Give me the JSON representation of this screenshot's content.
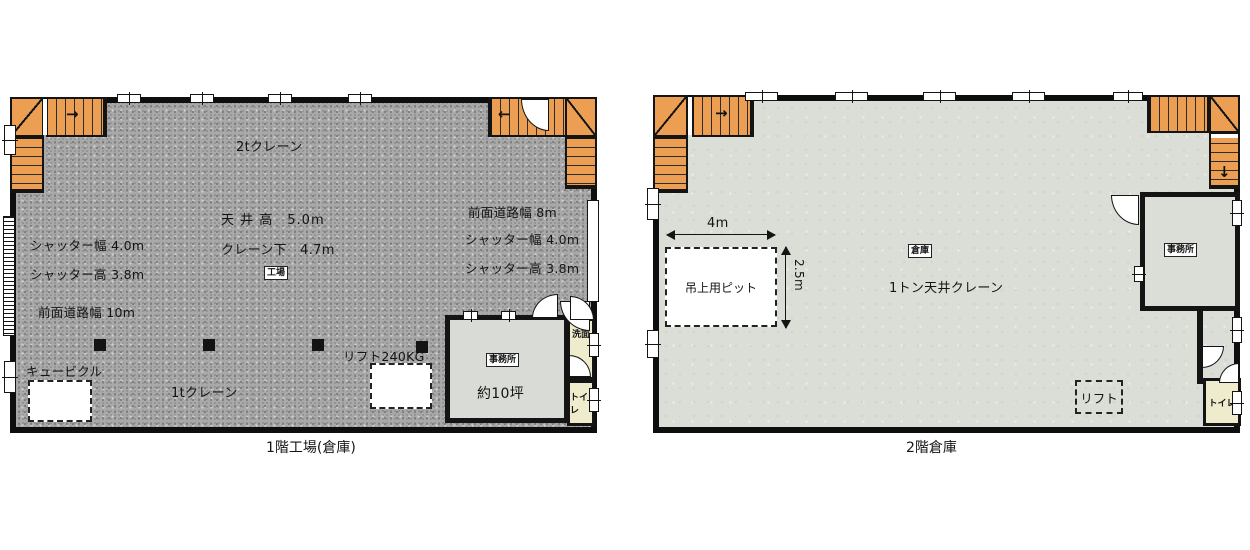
{
  "colors": {
    "wall": "#0e0e0e",
    "stair": "#ec9f52",
    "floor1": "#a9a9a9",
    "floor2": "#dbded7",
    "office": "#d9dcd6",
    "sanitary": "#efeccd"
  },
  "icons": {
    "arrow_right": "→",
    "arrow_left": "←",
    "arrow_down": "↓"
  },
  "floor1": {
    "caption": "1階工場(倉庫)",
    "crane_2t": "2tクレーン",
    "crane_1t": "1tクレーン",
    "ceiling_height": "天 井 高　5.0m",
    "under_crane": "クレーン下　4.7m",
    "factory_tag": "工場",
    "shutter_width_left": "シャッター幅 4.0m",
    "shutter_height_left": "シャッター高 3.8m",
    "front_road_left": "前面道路幅 10m",
    "front_road_right": "前面道路幅 8m",
    "shutter_width_right": "シャッター幅 4.0m",
    "shutter_height_right": "シャッター高 3.8m",
    "cubicle": "キュービクル",
    "lift": "リフト240KG",
    "office": "事務所",
    "office_area": "約10坪",
    "washroom": "洗面",
    "toilet": "トイレ"
  },
  "floor2": {
    "caption": "2階倉庫",
    "warehouse_tag": "倉庫",
    "crane": "1トン天井クレーン",
    "pit": "吊上用ピット",
    "pit_width": "4m",
    "pit_depth": "2.5m",
    "office": "事務所",
    "lift": "リフト",
    "toilet": "トイレ"
  }
}
